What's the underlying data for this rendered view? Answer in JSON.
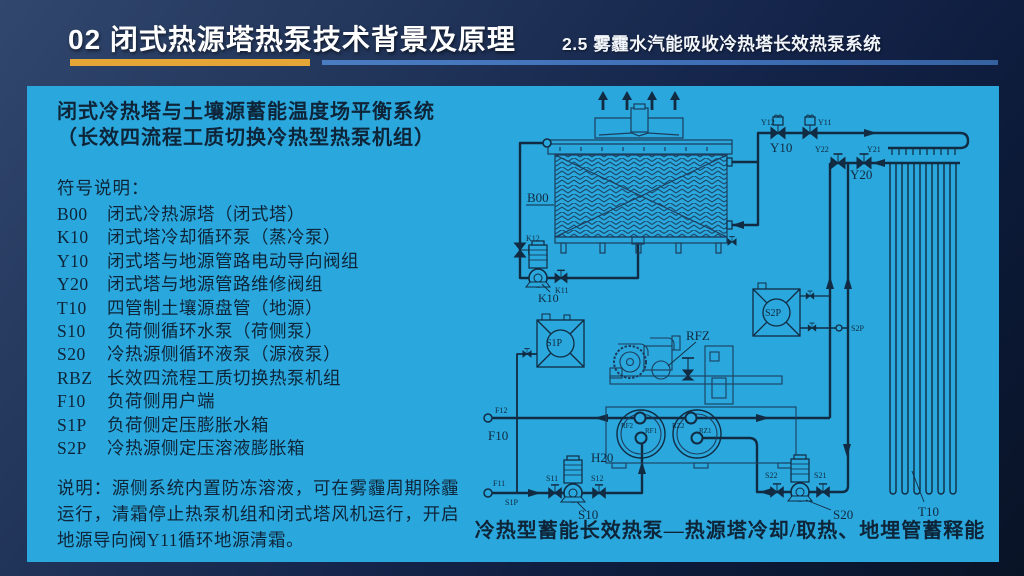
{
  "slide": {
    "title": "02 闭式热源塔热泵技术背景及原理",
    "subtitle": "2.5 雾霾水汽能吸收冷热塔长效热泵系统",
    "accent_gold": "#E6A637",
    "accent_blue": "#3E6EB5",
    "panel_bg": "#2AA7DC",
    "ink": "#112B42"
  },
  "panel": {
    "heading_line1": "闭式冷热塔与土壤源蓄能温度场平衡系统",
    "heading_line2": "（长效四流程工质切换冷热型热泵机组）",
    "legend_title": "符号说明：",
    "legend": [
      {
        "code": "B00",
        "desc": "闭式冷热源塔（闭式塔）"
      },
      {
        "code": "K10",
        "desc": "闭式塔冷却循环泵（蒸冷泵）"
      },
      {
        "code": "Y10",
        "desc": "闭式塔与地源管路电动导向阀组"
      },
      {
        "code": "Y20",
        "desc": "闭式塔与地源管路维修阀组"
      },
      {
        "code": "T10",
        "desc": "四管制土壤源盘管（地源）"
      },
      {
        "code": "S10",
        "desc": "负荷侧循环水泵（荷侧泵）"
      },
      {
        "code": "S20",
        "desc": "冷热源侧循环液泵（源液泵）"
      },
      {
        "code": "RBZ",
        "desc": "长效四流程工质切换热泵机组"
      },
      {
        "code": "F10",
        "desc": "负荷侧用户端"
      },
      {
        "code": "S1P",
        "desc": "负荷侧定压膨胀水箱"
      },
      {
        "code": "S2P",
        "desc": "冷热源侧定压溶液膨胀箱"
      }
    ],
    "note": "说明：源侧系统内置防冻溶液，可在雾霾周期除霾运行，清霜停止热泵机组和闭式塔风机运行，开启地源导向阀Y11循环地源清霜。",
    "caption": "冷热型蓄能长效热泵—热源塔冷却/取热、地埋管蓄释能"
  },
  "diagram": {
    "labels": {
      "b00": "B00",
      "k12": "K12",
      "k11": "K11",
      "k10": "K10",
      "y12": "Y12",
      "y11": "Y11",
      "y10": "Y10",
      "y22": "Y22",
      "y21": "Y21",
      "y20": "Y20",
      "rfz": "RFZ",
      "h20": "H20",
      "s1p_tank": "S1P",
      "s2p_tank": "S2P",
      "s2p_point": "S2P",
      "f12": "F12",
      "f10": "F10",
      "f11": "F11",
      "s1p_point": "S1P",
      "s11": "S11",
      "s12": "S12",
      "s10": "S10",
      "rf2": "RF2",
      "rf1": "RF1",
      "rz2": "RZ2",
      "rz1": "RZ1",
      "s22": "S22",
      "s21": "S21",
      "s20": "S20",
      "t10": "T10"
    }
  }
}
